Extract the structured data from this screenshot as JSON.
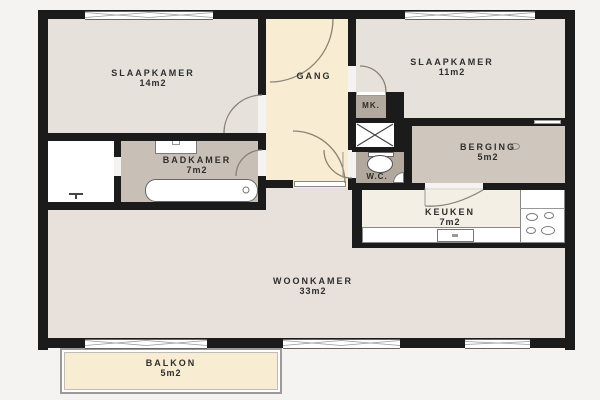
{
  "rooms": {
    "slaapkamer1": {
      "label": "SLAAPKAMER",
      "area": "14m2"
    },
    "gang": {
      "label": "GANG"
    },
    "slaapkamer2": {
      "label": "SLAAPKAMER",
      "area": "11m2"
    },
    "mk": {
      "label": "MK."
    },
    "berging": {
      "label": "BERGING",
      "area": "5m2"
    },
    "badkamer": {
      "label": "BADKAMER",
      "area": "7m2"
    },
    "wc": {
      "label": "W.C."
    },
    "keuken": {
      "label": "KEUKEN",
      "area": "7m2"
    },
    "woonkamer": {
      "label": "WOONKAMER",
      "area": "33m2"
    },
    "balkon": {
      "label": "BALKON",
      "area": "5m2"
    }
  },
  "colors": {
    "wall": "#1b1b1b",
    "background": "#f4f3f1",
    "bedroom_light": "#e6e1db",
    "woonkamer": "#e8e0da",
    "hallway_cream": "#f8edd3",
    "badkamer": "#c8c0b7",
    "berging": "#cfc7be",
    "utility_taupe": "#b2a89e",
    "keuken": "#f3efe5",
    "fixture_white": "#ffffff"
  }
}
